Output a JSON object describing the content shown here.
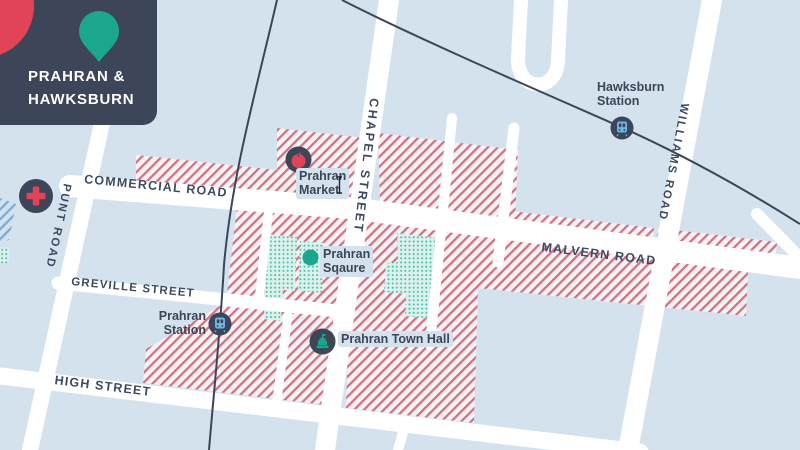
{
  "header": {
    "title": "PRAHRAN &\nHAWKSBURN"
  },
  "roads": {
    "commercial": "COMMERCIAL ROAD",
    "malvern": "MALVERN ROAD",
    "greville": "GREVILLE STREET",
    "high": "HIGH STREET",
    "punt": "PUNT ROAD",
    "chapel": "CHAPEL STREET",
    "williams": "WILLIAMS ROAD"
  },
  "pois": {
    "market": "Prahran\nMarket",
    "square": "Prahran\nSqaure",
    "prahran_station": "Prahran\nStation",
    "hawksburn_station": "Hawksburn\nStation",
    "town_hall": "Prahran Town Hall"
  },
  "icons": [
    "map-pin",
    "hospital-cross",
    "market-apple",
    "train",
    "square-marker",
    "town-hall",
    "text-cursor"
  ],
  "colors": {
    "background": "#d4e2ee",
    "navy": "#3d4558",
    "teal": "#1ba78e",
    "red": "#e04456",
    "road": "#ffffff",
    "hatch_stripe": "#cd7487",
    "hatch_bg": "#f8f1f2",
    "park_dot": "#44bfac",
    "park_bg": "#dcf1ec",
    "blue_stripe": "#79add6",
    "train_glyph": "#6cb5e5"
  }
}
